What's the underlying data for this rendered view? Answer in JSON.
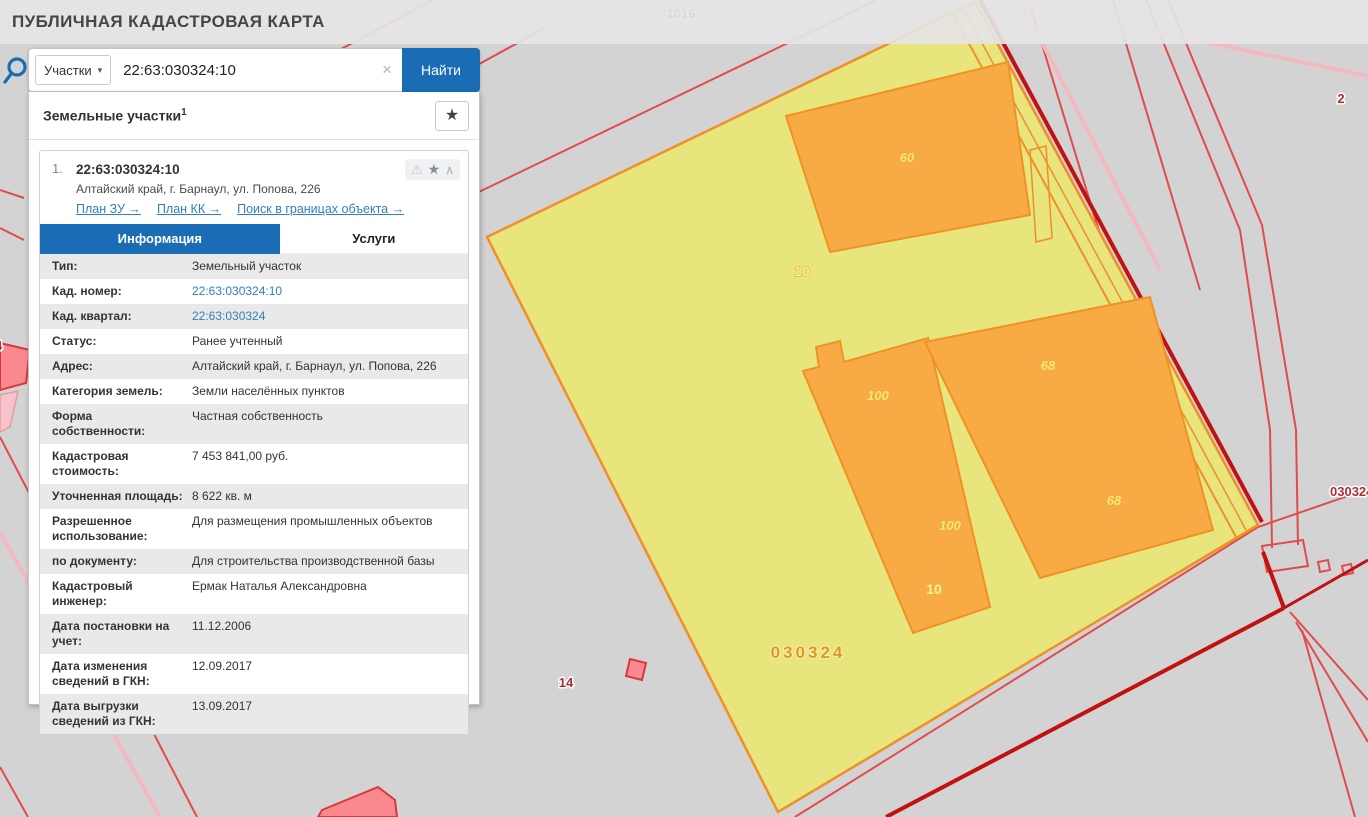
{
  "header": {
    "title": "ПУБЛИЧНАЯ КАДАСТРОВАЯ КАРТА"
  },
  "search": {
    "category_label": "Участки",
    "category_caret": "▾",
    "query": "22:63:030324:10",
    "clear_label": "×",
    "submit_label": "Найти"
  },
  "panel": {
    "title": "Земельные участки",
    "count_superscript": "1",
    "favorite_star": "★",
    "result": {
      "index": "1.",
      "cad_number": "22:63:030324:10",
      "address": "Алтайский край, г. Барнаул, ул. Попова, 226",
      "icons": {
        "warning": "⚠",
        "star": "★",
        "collapse": "∧"
      },
      "links": [
        {
          "name": "plan-zu-link",
          "label": "План ЗУ →"
        },
        {
          "name": "plan-kk-link",
          "label": "План КК →"
        },
        {
          "name": "search-in-bounds-link",
          "label": "Поиск в границах объекта →"
        }
      ],
      "tabs": [
        {
          "name": "tab-information",
          "label": "Информация",
          "active": true
        },
        {
          "name": "tab-services",
          "label": "Услуги",
          "active": false
        }
      ],
      "rows": [
        {
          "label": "Тип:",
          "value": "Земельный участок"
        },
        {
          "label": "Кад. номер:",
          "value": "22:63:030324:10",
          "link": true
        },
        {
          "label": "Кад. квартал:",
          "value": "22:63:030324",
          "link": true
        },
        {
          "label": "Статус:",
          "value": "Ранее учтенный"
        },
        {
          "label": "Адрес:",
          "value": "Алтайский край, г. Барнаул, ул. Попова, 226"
        },
        {
          "label": "Категория земель:",
          "value": "Земли населённых пунктов"
        },
        {
          "label": "Форма собственности:",
          "value": "Частная собственность"
        },
        {
          "label": "Кадастровая стоимость:",
          "value": "7 453 841,00 руб."
        },
        {
          "label": "Уточненная площадь:",
          "value": "8 622 кв. м"
        },
        {
          "label": "Разрешенное использование:",
          "value": "Для размещения промышленных объектов"
        },
        {
          "label": "по документу:",
          "value": "Для строительства производственной базы"
        },
        {
          "label": "Кадастровый инженер:",
          "value": "Ермак Наталья Александровна"
        },
        {
          "label": "Дата постановки на учет:",
          "value": "11.12.2006"
        },
        {
          "label": "Дата изменения сведений в ГКН:",
          "value": "12.09.2017"
        },
        {
          "label": "Дата выгрузки сведений из ГКН:",
          "value": "13.09.2017"
        }
      ]
    }
  },
  "map": {
    "colors": {
      "background_gray": "#d3d3d4",
      "parcel_yellow": "#e7e57b",
      "parcel_edge_orange": "#ef8f2a",
      "building_orange": "#f8ab45",
      "cadastral_line_red": "#e14b4b",
      "road_thick_red": "#c11212",
      "pink_line": "#f5b8c0",
      "accent_blue": "#1a6cb4"
    },
    "labels": [
      {
        "text": "1016",
        "x": 681,
        "y": 18,
        "cls": "red"
      },
      {
        "text": "2",
        "x": 1341,
        "y": 103,
        "cls": "red"
      },
      {
        "text": "14",
        "x": 566,
        "y": 687,
        "cls": "red"
      },
      {
        "text": "030324",
        "x": 1330,
        "y": 496,
        "cls": "red start"
      },
      {
        "text": "4",
        "x": -5,
        "y": 350,
        "cls": "red start"
      },
      {
        "text": "10",
        "x": 802,
        "y": 276,
        "cls": "yel-b"
      },
      {
        "text": "60",
        "x": 907,
        "y": 162,
        "cls": "yel-i"
      },
      {
        "text": "100",
        "x": 878,
        "y": 400,
        "cls": "yel-i"
      },
      {
        "text": "100",
        "x": 950,
        "y": 530,
        "cls": "yel-i"
      },
      {
        "text": "68",
        "x": 1048,
        "y": 370,
        "cls": "yel-i"
      },
      {
        "text": "68",
        "x": 1114,
        "y": 505,
        "cls": "yel-i"
      },
      {
        "text": "10",
        "x": 934,
        "y": 594,
        "cls": "yel-b"
      },
      {
        "text": "030324",
        "x": 808,
        "y": 658,
        "cls": "quarter"
      }
    ]
  }
}
